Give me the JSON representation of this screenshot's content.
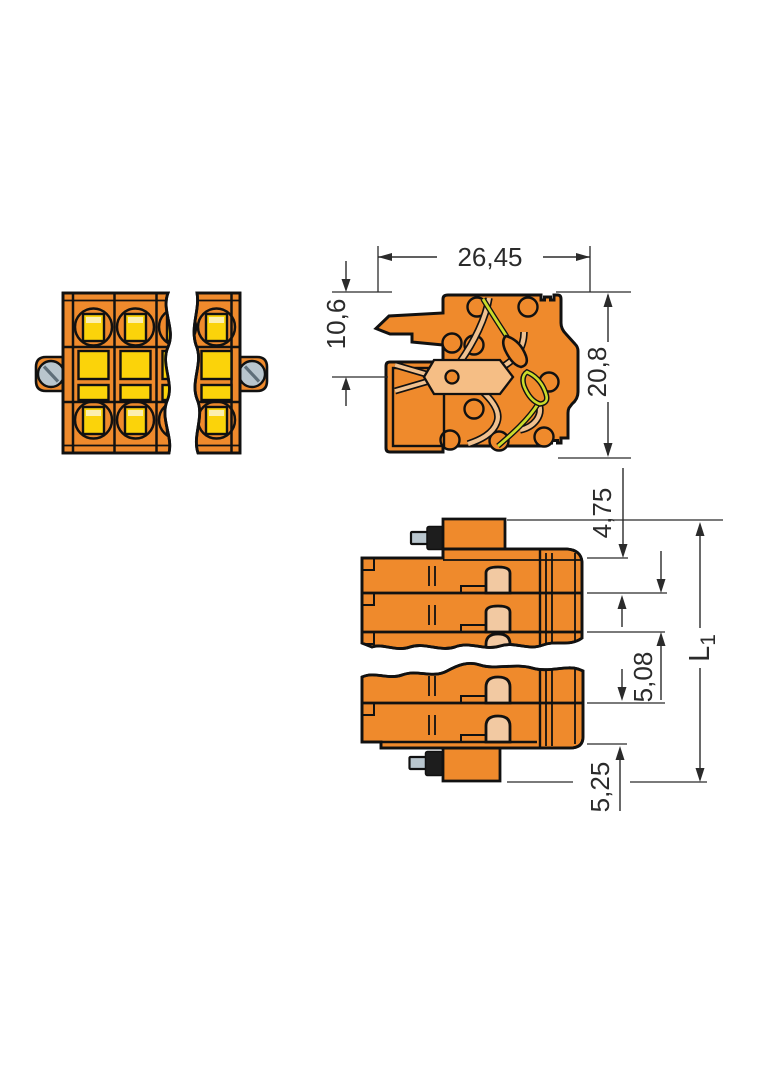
{
  "drawing": {
    "colors": {
      "body_orange": "#EF8A2C",
      "insert_yellow": "#FBD30A",
      "insert_highlight": "#FCEFAF",
      "opening_tan": "#F2C9A2",
      "contact_tan": "#F0C18F",
      "plate_tan": "#F5BE85",
      "spring_green": "#CBDB2A",
      "screw_gray": "#B9C6CE",
      "outline_black": "#111111",
      "dimension_gray": "#2B2B2B",
      "background": "#FFFFFF"
    },
    "front_view": {
      "pole_columns_visible": 4,
      "has_break_symbol": true,
      "flange_screw_count": 2
    },
    "section_view": {
      "dim_width": "26,45",
      "dim_wire_entry_height": "10,6",
      "dim_total_height": "20,8"
    },
    "side_view": {
      "has_break_symbol": true,
      "dim_flange_extension_top": "4,75",
      "dim_pole_pitch": "5,08",
      "dim_flange_extension_bottom": "5,25",
      "dim_total_length_symbol": "L",
      "dim_total_length_subscript": "1"
    }
  }
}
